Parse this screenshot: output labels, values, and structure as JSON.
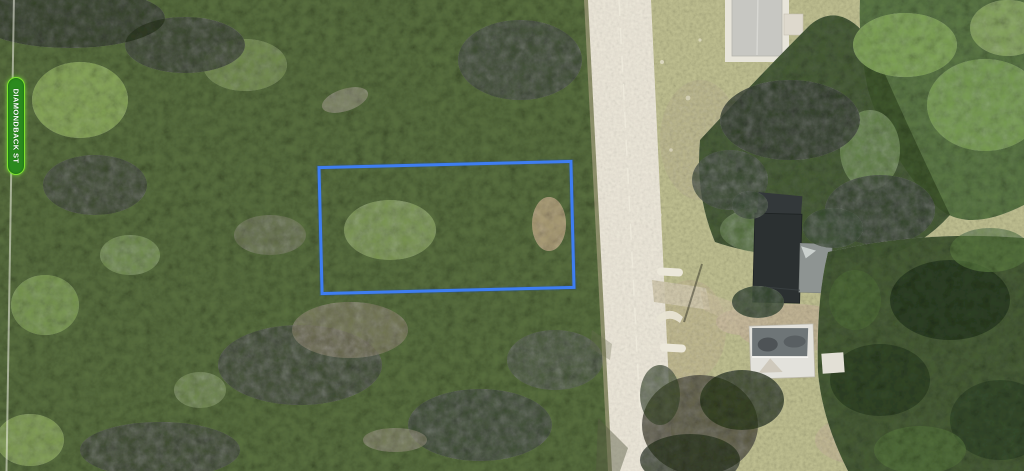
{
  "map": {
    "view": "satellite-aerial",
    "street_label": {
      "text": "DIAMONDBACK ST",
      "orientation": "vertical"
    },
    "parcel_outline": {
      "shape": "rectangle",
      "color": "#3e7ef2"
    },
    "colors": {
      "parcel_outline": "#3e7ef2",
      "street_badge_fill": "#2b8a1e",
      "street_badge_border": "#7fe32f",
      "street_badge_text": "#ffffff",
      "forest_base": "#5a7040",
      "grass_base": "#c2c293",
      "road": "#ece7d9",
      "road_centerline": "#efebdd",
      "shoulder_dirt": "#b9ad90",
      "sand": "#c4b697",
      "roof_light_gray": "#c7c7c2",
      "roof_dark": "#2b3031",
      "roof_annex_gray": "#8e9492",
      "roof_white": "#e3e2dc",
      "concrete_white": "#ece8da",
      "boundary_line": "#f0f0e6"
    },
    "features": [
      {
        "name": "street-name-badge",
        "label": "DIAMONDBACK ST"
      },
      {
        "name": "parcel-outline",
        "shape": "rectangle"
      },
      {
        "name": "road",
        "orientation": "vertical"
      },
      {
        "name": "building-top",
        "roof": "light gray"
      },
      {
        "name": "building-main",
        "roof": "dark"
      },
      {
        "name": "building-lower",
        "roof": "white gable"
      },
      {
        "name": "culvert-markers",
        "count": 3
      },
      {
        "name": "driveway",
        "surface": "sand"
      },
      {
        "name": "forest-canopy",
        "coverage": "dense"
      }
    ]
  }
}
